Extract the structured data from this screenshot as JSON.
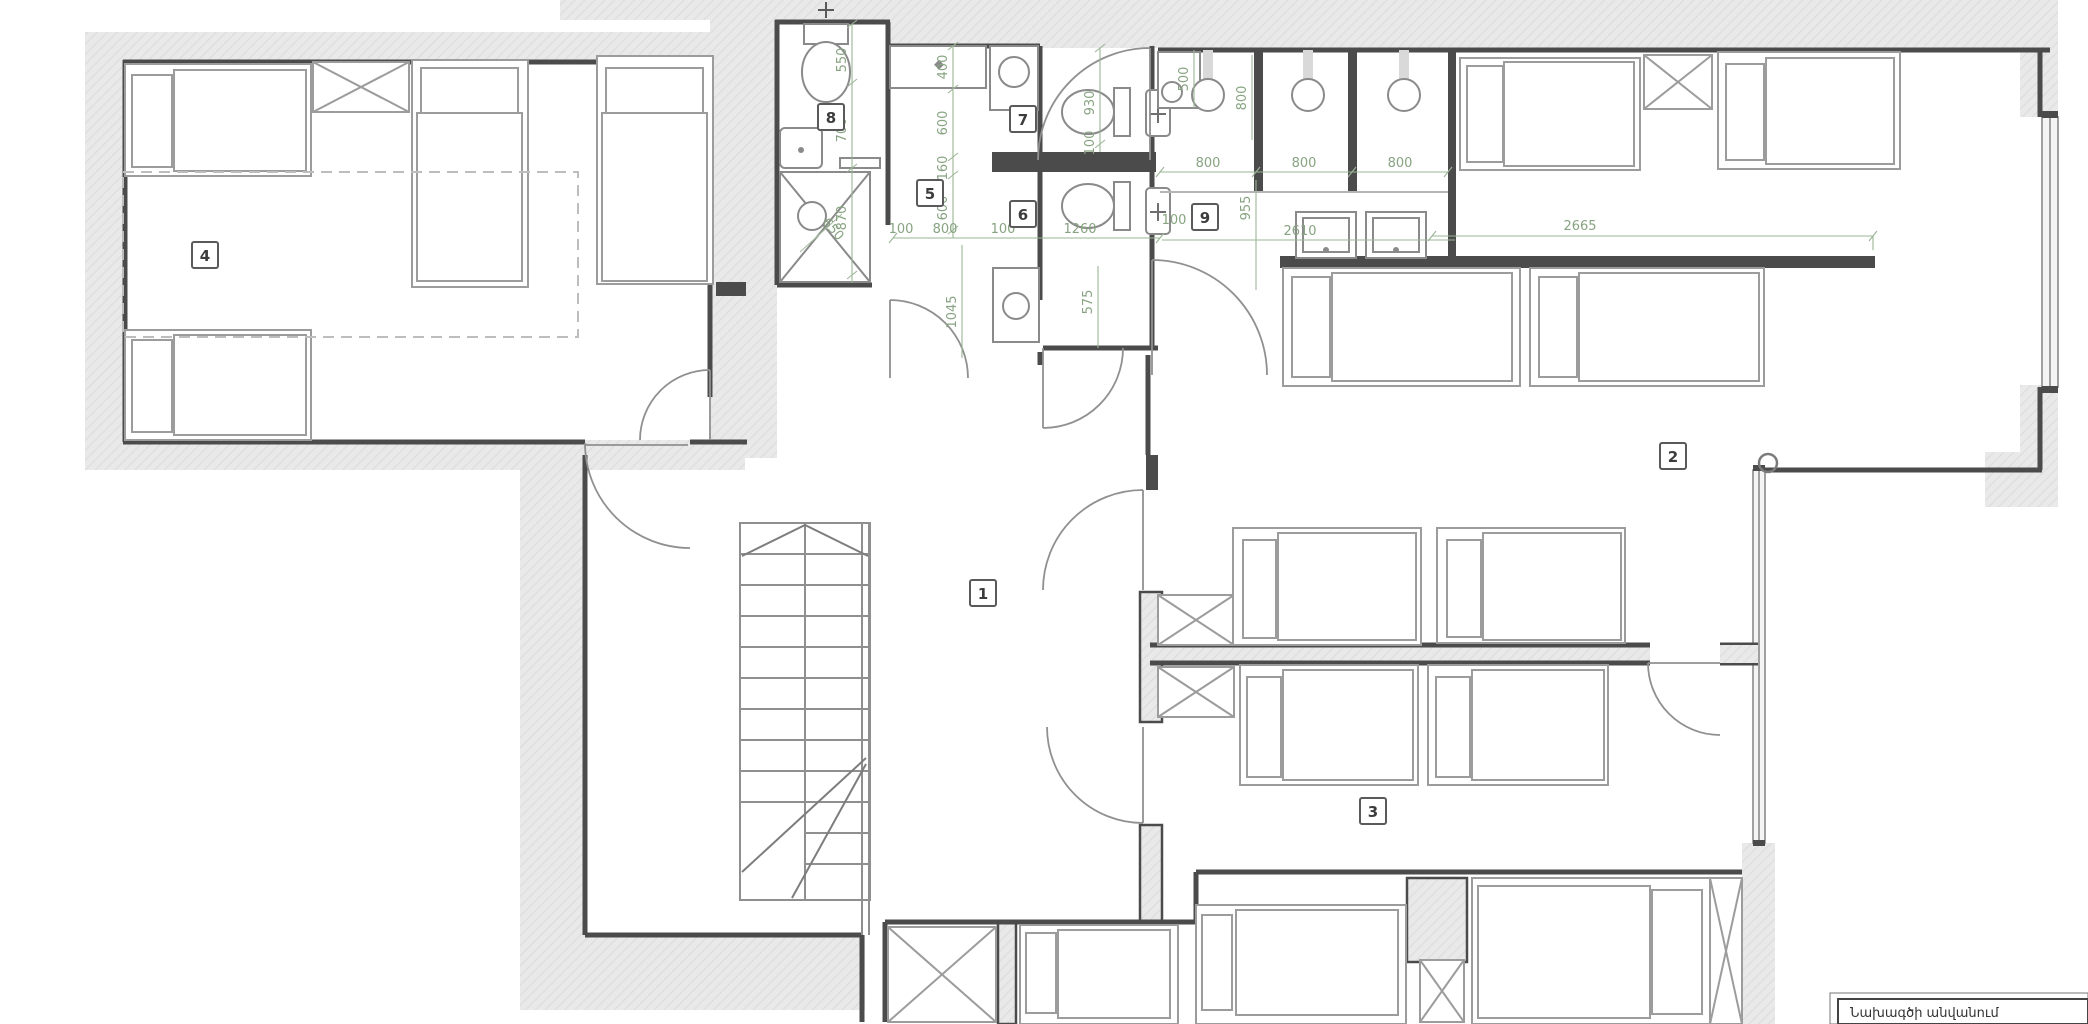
{
  "drawing": {
    "title_block_label": "Նախագծի անվանում",
    "room_labels": {
      "r1": "1",
      "r2": "2",
      "r3": "3",
      "r4": "4",
      "r5": "5",
      "r6": "6",
      "r7": "7",
      "r8": "8",
      "r9": "9"
    },
    "dim_labels": {
      "d01": "400",
      "d02": "600",
      "d03": "160",
      "d04": "600",
      "d05": "100",
      "d06": "800",
      "d07": "100",
      "d08": "1260",
      "d09": "550",
      "d10": "700",
      "d11": "870",
      "d12": "650",
      "d13": "930",
      "d14": "100",
      "d15": "575",
      "d16": "1045",
      "d17": "500",
      "d18": "800",
      "d19": "800",
      "d20": "800",
      "d21": "800",
      "d22": "955",
      "d23": "100",
      "d24": "2610",
      "d25": "2665"
    },
    "colors": {
      "dimension_green": "#87a381",
      "wall_dark": "#4b4b4b",
      "poche_fill": "#e9e9e9",
      "furniture_line": "#9c9c9c"
    }
  }
}
